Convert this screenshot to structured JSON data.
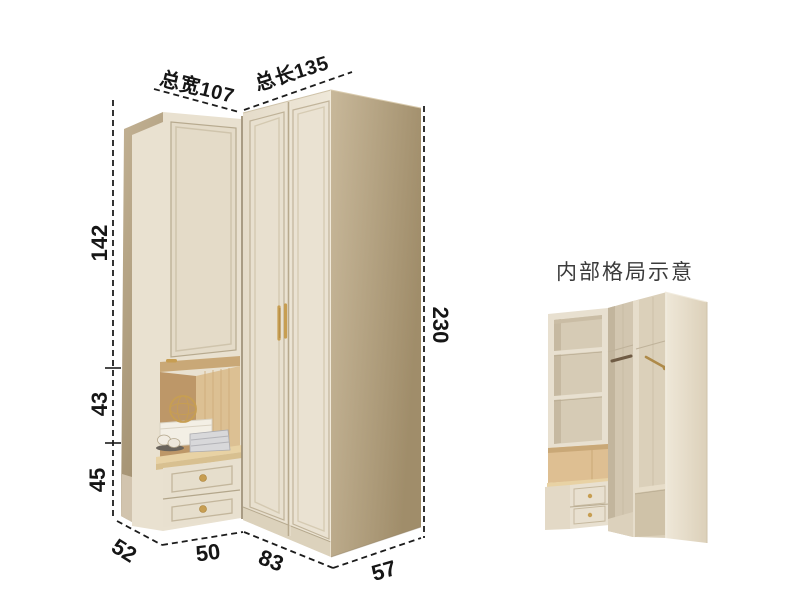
{
  "background": "#ffffff",
  "main_diagram": {
    "total_width_label": "总宽107",
    "total_length_label": "总长135",
    "upper_height": "142",
    "middle_height": "43",
    "lower_height": "45",
    "total_height": "230",
    "left_depth": "52",
    "drawer_section_width": "50",
    "door_section_width": "83",
    "right_depth": "57"
  },
  "inset_diagram": {
    "title": "内部格局示意"
  },
  "colors": {
    "cabinet_front": "#e9e1d0",
    "cabinet_side_panel": "#ab9a7b",
    "wood_accent": "#dcc093",
    "countertop_wood": "#e8d2a4",
    "handle_gold": "#c79e52",
    "dimension_line": "#1c1c1c",
    "inset_title_text": "#3b3b3b"
  }
}
